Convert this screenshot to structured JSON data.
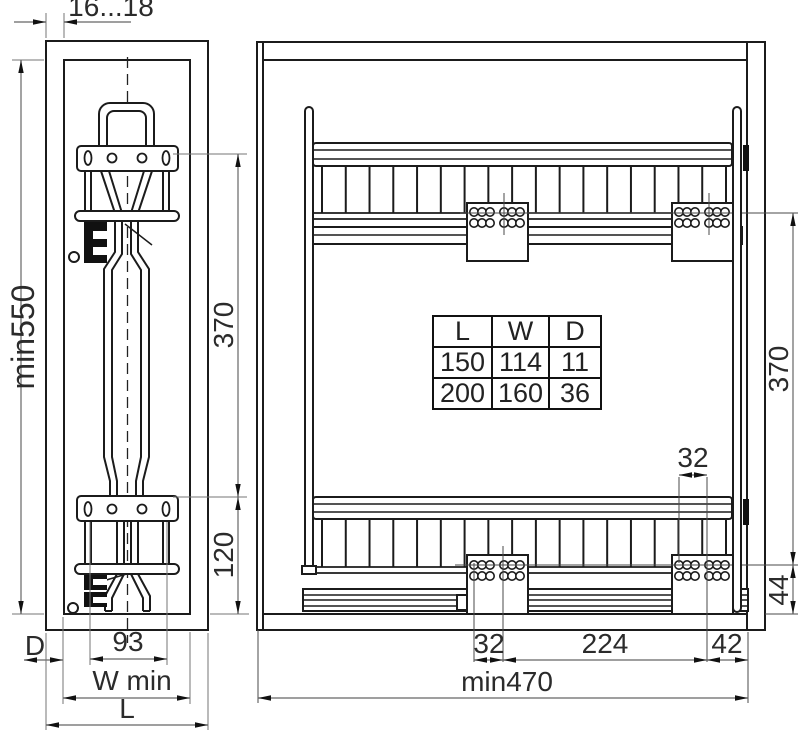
{
  "left_view": {
    "panel_thickness": "16...18",
    "min_height": "min550",
    "upper_bracket_distance": "370",
    "lower_bracket_distance": "120",
    "bracket_hole_spacing": "93",
    "depth_label": "D",
    "min_width_label": "W min",
    "length_label": "L"
  },
  "right_view": {
    "rear_hole_pitch": "32",
    "runner_distance": "370",
    "bottom_offset": "44",
    "front_hole_pitch": "32",
    "hole_span": "224",
    "rear_offset": "42",
    "min_depth": "min470"
  },
  "size_table": {
    "headers": [
      "L",
      "W",
      "D"
    ],
    "rows": [
      [
        "150",
        "114",
        "11"
      ],
      [
        "200",
        "160",
        "36"
      ]
    ]
  },
  "colors": {
    "line": "#1b1b1b",
    "dimension_line": "#666666",
    "text": "#2b2b2b",
    "background": "#ffffff"
  }
}
